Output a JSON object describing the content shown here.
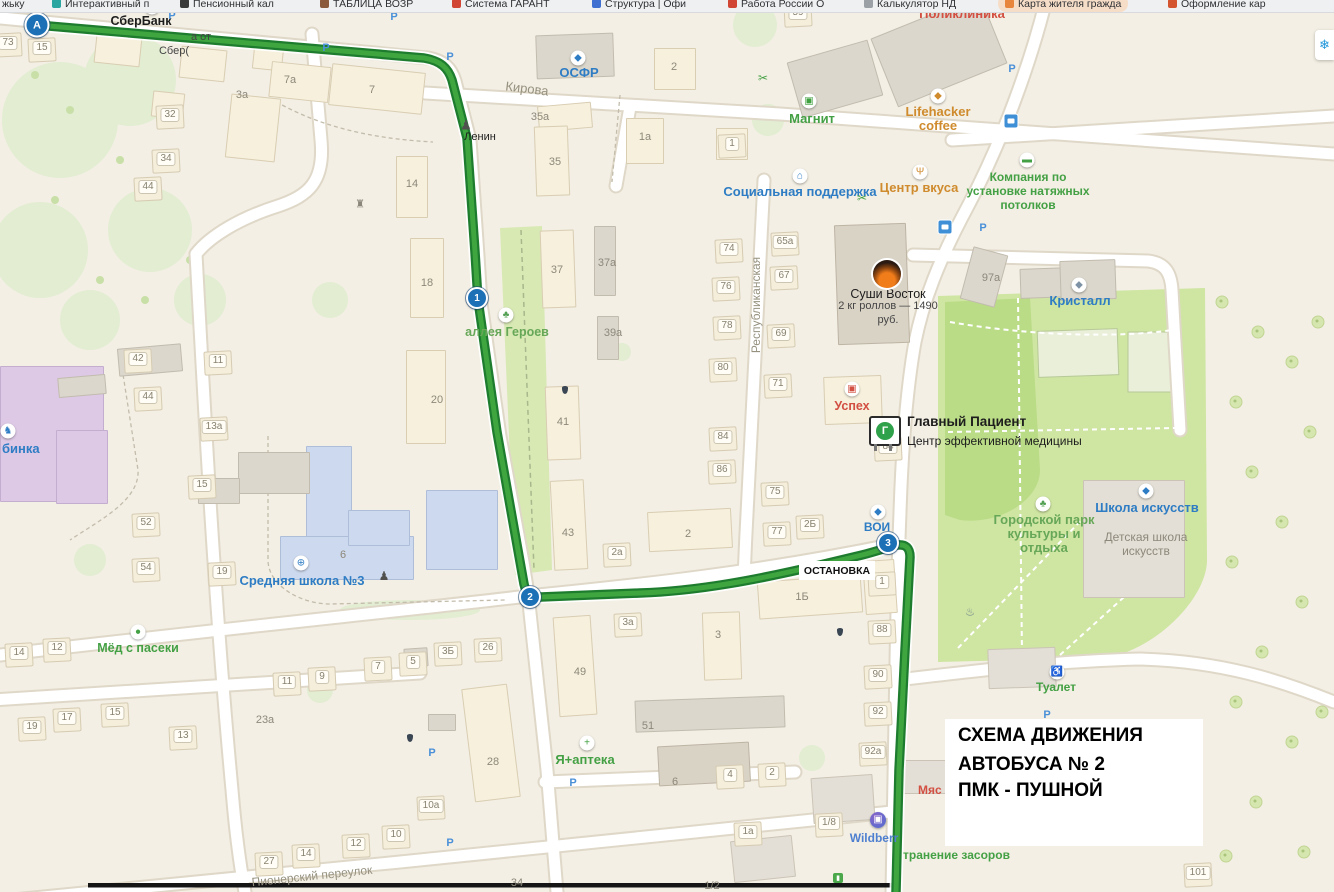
{
  "browser_bar": {
    "bookmarks": [
      {
        "label": "жьку",
        "icon": "",
        "x": 2
      },
      {
        "label": "Интерактивный п",
        "icon": "#2aa5a0",
        "x": 52
      },
      {
        "label": "Пенсионный кал",
        "icon": "#3a3a3a",
        "x": 180
      },
      {
        "label": "ТАБЛИЦА ВОЗР",
        "icon": "#8b5a3c",
        "x": 320
      },
      {
        "label": "Система ГАРАНТ",
        "icon": "#d04534",
        "x": 452
      },
      {
        "label": "Структура | Офи",
        "icon": "#3f6fd0",
        "x": 592
      },
      {
        "label": "Работа России О",
        "icon": "#d04534",
        "x": 728
      },
      {
        "label": "Калькулятор НД",
        "icon": "#9aa0a6",
        "x": 864
      },
      {
        "label": "Карта жителя гражда",
        "icon": "#e8853c",
        "x": 998,
        "highlighted": true
      },
      {
        "label": "Оформление кар",
        "icon": "#d3542e",
        "x": 1168
      }
    ]
  },
  "map": {
    "schema_box": {
      "line1": "СХЕМА ДВИЖЕНИЯ",
      "line2": "АВТОБУСА № 2",
      "line3": "ПМК - ПУШНОЙ"
    },
    "stop_label": "ОСТАНОВКА",
    "billboard_letter": "Г",
    "snowflake": "❄",
    "accent_colors": {
      "route_green": "#3fa53f",
      "marker_blue": "#1c70b6",
      "poi_blue": "#2d7cc4",
      "poi_green": "#44a044",
      "poi_red": "#d24f42",
      "poi_orange": "#cf8b2d"
    },
    "route_markers": [
      {
        "label": "А",
        "x": 37,
        "y": 25,
        "s": 21
      },
      {
        "label": "1",
        "x": 477,
        "y": 298,
        "s": 18
      },
      {
        "label": "2",
        "x": 530,
        "y": 597,
        "s": 18
      },
      {
        "label": "3",
        "x": 888,
        "y": 543,
        "s": 18
      }
    ],
    "labels": [
      {
        "n": "poi-sberbank",
        "t": "СберБанк",
        "x": 141,
        "y": 21,
        "c": "blk",
        "z": 12.5,
        "b": 1
      },
      {
        "n": "poi-sber-ad-line1",
        "t": "а от",
        "x": 201,
        "y": 37,
        "c": "blk2",
        "z": 11
      },
      {
        "n": "poi-sber-ad-line2",
        "t": "Сбер(",
        "x": 174,
        "y": 51,
        "c": "blk2",
        "z": 11
      },
      {
        "n": "poi-osfr",
        "t": "ОСФР",
        "x": 579,
        "y": 73,
        "c": "blue",
        "z": 13
      },
      {
        "n": "street-kirova",
        "t": "Кирова",
        "x": 527,
        "y": 89,
        "c": "street",
        "z": 13,
        "r": 7
      },
      {
        "n": "poi-lenin",
        "t": "Ленин",
        "x": 480,
        "y": 137,
        "c": "blk",
        "z": 11
      },
      {
        "n": "poi-poliklinika",
        "t": "Поликлиника",
        "x": 962,
        "y": 14,
        "c": "red",
        "z": 13
      },
      {
        "n": "poi-magnit",
        "t": "Магнит",
        "x": 812,
        "y": 119,
        "c": "green",
        "z": 13
      },
      {
        "n": "poi-lifehacker",
        "t": "Lifehacker\ncoffee",
        "x": 938,
        "y": 119,
        "c": "orange",
        "z": 13
      },
      {
        "n": "poi-centr-vkusa",
        "t": "Центр вкуса",
        "x": 919,
        "y": 188,
        "c": "orange",
        "z": 13
      },
      {
        "n": "poi-potolki",
        "t": "Компания по\nустановке натяжных\nпотолков",
        "x": 1028,
        "y": 191,
        "c": "green",
        "z": 12
      },
      {
        "n": "poi-soc-podderzhka",
        "t": "Социальная поддержка",
        "x": 800,
        "y": 192,
        "c": "blue",
        "z": 13
      },
      {
        "n": "poi-sushi-title",
        "t": "Суши Восток",
        "x": 888,
        "y": 294,
        "c": "blk",
        "z": 12.5
      },
      {
        "n": "poi-sushi-sub",
        "t": "2 кг роллов — 1490\nруб.",
        "x": 888,
        "y": 313,
        "c": "blk2",
        "z": 11
      },
      {
        "n": "street-respublikanskaya",
        "t": "Республиканская",
        "x": 756,
        "y": 305,
        "c": "street",
        "z": 12,
        "r": -90
      },
      {
        "n": "poi-kristall",
        "t": "Кристалл",
        "x": 1080,
        "y": 301,
        "c": "blue",
        "z": 13
      },
      {
        "n": "poi-uspeh",
        "t": "Успех",
        "x": 852,
        "y": 406,
        "c": "red",
        "z": 12.5
      },
      {
        "n": "poi-glavny-patsient",
        "t": "Главный Пациент",
        "x": 907,
        "y": 422,
        "c": "blk",
        "z": 13.5,
        "b": 1,
        "a": "l"
      },
      {
        "n": "poi-glavny-patsient-sub",
        "t": "Центр эффективной медицины",
        "x": 907,
        "y": 441,
        "c": "blk",
        "z": 12,
        "a": "l"
      },
      {
        "n": "poi-voi",
        "t": "ВОИ",
        "x": 877,
        "y": 527,
        "c": "blue",
        "z": 12
      },
      {
        "n": "poi-gorodskoy-park",
        "t": "Городской парк\nкультуры и\nотдыха",
        "x": 1044,
        "y": 534,
        "c": "parkgreen",
        "z": 13
      },
      {
        "n": "poi-shkola-iskusstv",
        "t": "Школа искусств",
        "x": 1147,
        "y": 508,
        "c": "blue",
        "z": 13
      },
      {
        "n": "poi-detskaya-shkola",
        "t": "Детская школа\nискусств",
        "x": 1146,
        "y": 544,
        "c": "grey",
        "z": 12
      },
      {
        "n": "poi-srednyaya-shkola-3",
        "t": "Средняя школа №3",
        "x": 302,
        "y": 581,
        "c": "blue",
        "z": 13
      },
      {
        "n": "poi-alleya-geroev",
        "t": "аллея Героев",
        "x": 507,
        "y": 332,
        "c": "parkgreen",
        "z": 12.5
      },
      {
        "n": "poi-med-s-paseki",
        "t": "Мёд с пасеки",
        "x": 138,
        "y": 648,
        "c": "green",
        "z": 12.5
      },
      {
        "n": "poi-ya-apteka",
        "t": "Я+аптека",
        "x": 585,
        "y": 760,
        "c": "green",
        "z": 13
      },
      {
        "n": "poi-tualet",
        "t": "Туалет",
        "x": 1056,
        "y": 687,
        "c": "green",
        "z": 12
      },
      {
        "n": "poi-wildberries",
        "t": "Wildberr",
        "x": 874,
        "y": 838,
        "c": "wb",
        "z": 12
      },
      {
        "n": "poi-zasory",
        "t": "транение засоров",
        "x": 903,
        "y": 855,
        "c": "green",
        "z": 12,
        "a": "l"
      },
      {
        "n": "poi-myas",
        "t": "Мяс",
        "x": 918,
        "y": 790,
        "c": "red",
        "z": 12,
        "a": "l"
      },
      {
        "n": "poi-ryabinka",
        "t": "бинка",
        "x": 2,
        "y": 449,
        "c": "blue",
        "z": 13,
        "a": "l"
      },
      {
        "n": "street-pionersky",
        "t": "Пионерский переулок",
        "x": 312,
        "y": 876,
        "c": "street",
        "z": 12,
        "r": -6
      }
    ],
    "building_numbers_chip": [
      [
        "73",
        8,
        43
      ],
      [
        "15",
        42,
        48
      ],
      [
        "32",
        170,
        115
      ],
      [
        "34",
        166,
        159
      ],
      [
        "44",
        148,
        187
      ],
      [
        "42",
        138,
        359
      ],
      [
        "44",
        148,
        397
      ],
      [
        "11",
        218,
        361
      ],
      [
        "13а",
        214,
        427
      ],
      [
        "15",
        202,
        485
      ],
      [
        "52",
        146,
        523
      ],
      [
        "54",
        146,
        568
      ],
      [
        "19",
        222,
        572
      ],
      [
        "14",
        19,
        653
      ],
      [
        "12",
        57,
        648
      ],
      [
        "19",
        32,
        727
      ],
      [
        "17",
        67,
        718
      ],
      [
        "15",
        115,
        713
      ],
      [
        "13",
        183,
        736
      ],
      [
        "11",
        287,
        682
      ],
      [
        "9",
        322,
        677
      ],
      [
        "7",
        378,
        667
      ],
      [
        "5",
        413,
        662
      ],
      [
        "3Б",
        448,
        652
      ],
      [
        "26",
        488,
        648
      ],
      [
        "2а",
        617,
        553
      ],
      [
        "3а",
        628,
        623
      ],
      [
        "59",
        798,
        13
      ],
      [
        "74",
        729,
        249
      ],
      [
        "65а",
        785,
        242
      ],
      [
        "67",
        784,
        276
      ],
      [
        "76",
        726,
        287
      ],
      [
        "78",
        727,
        326
      ],
      [
        "69",
        781,
        334
      ],
      [
        "80",
        723,
        368
      ],
      [
        "71",
        778,
        384
      ],
      [
        "84",
        723,
        437
      ],
      [
        "86",
        722,
        470
      ],
      [
        "75",
        775,
        492
      ],
      [
        "77",
        777,
        532
      ],
      [
        "2Б",
        810,
        525
      ],
      [
        "1",
        882,
        582
      ],
      [
        "88",
        882,
        630
      ],
      [
        "90",
        878,
        675
      ],
      [
        "92",
        878,
        712
      ],
      [
        "92а",
        873,
        752
      ],
      [
        "84",
        888,
        447
      ],
      [
        "1",
        732,
        144
      ],
      [
        "27",
        269,
        862
      ],
      [
        "14",
        306,
        854
      ],
      [
        "12",
        356,
        844
      ],
      [
        "10",
        396,
        835
      ],
      [
        "10а",
        431,
        806
      ],
      [
        "1а",
        748,
        832
      ],
      [
        "1/8",
        829,
        823
      ],
      [
        "101",
        1198,
        873
      ],
      [
        "4",
        730,
        775
      ],
      [
        "2",
        772,
        773
      ]
    ],
    "building_numbers_plain": [
      [
        "3а",
        242,
        95
      ],
      [
        "7а",
        290,
        80
      ],
      [
        "7",
        372,
        90
      ],
      [
        "14",
        412,
        184
      ],
      [
        "18",
        427,
        283
      ],
      [
        "20",
        437,
        400
      ],
      [
        "35а",
        540,
        117
      ],
      [
        "35",
        555,
        162
      ],
      [
        "37",
        557,
        270
      ],
      [
        "37а",
        607,
        263
      ],
      [
        "39а",
        613,
        333
      ],
      [
        "41",
        563,
        422
      ],
      [
        "43",
        568,
        533
      ],
      [
        "2",
        688,
        534
      ],
      [
        "49",
        580,
        672
      ],
      [
        "28",
        493,
        762
      ],
      [
        "51",
        648,
        726
      ],
      [
        "1Б",
        802,
        597
      ],
      [
        "3",
        718,
        635
      ],
      [
        "97а",
        991,
        278
      ],
      [
        "6",
        343,
        555
      ],
      [
        "2",
        674,
        67
      ],
      [
        "1а",
        645,
        137
      ],
      [
        "23а",
        265,
        720
      ],
      [
        "34",
        517,
        883
      ],
      [
        "6",
        675,
        782
      ],
      [
        "1/2",
        712,
        886
      ]
    ],
    "icons": [
      {
        "n": "sber-logo-icon",
        "g": "◆",
        "c": "#57a636",
        "x": 152,
        "y": 7,
        "bg": 1
      },
      {
        "n": "osfr-icon",
        "g": "◆",
        "c": "#2d7cc4",
        "x": 578,
        "y": 58,
        "bg": 1
      },
      {
        "n": "lenin-monument-icon",
        "g": "♟",
        "c": "#50504e",
        "x": 466,
        "y": 125,
        "s": 13
      },
      {
        "n": "monument-icon",
        "g": "♜",
        "c": "#8a867a",
        "x": 360,
        "y": 205,
        "s": 11
      },
      {
        "n": "magnit-cart-icon",
        "g": "▣",
        "c": "#3fa03f",
        "x": 809,
        "y": 101,
        "bg": 1
      },
      {
        "n": "lifehacker-icon",
        "g": "◆",
        "c": "#cf8b2d",
        "x": 938,
        "y": 96,
        "bg": 1
      },
      {
        "n": "restaurant-icon",
        "g": "Ψ",
        "c": "#cf8b2d",
        "x": 920,
        "y": 172,
        "bg": 1
      },
      {
        "n": "paint-roller-icon",
        "g": "▬",
        "c": "#44a044",
        "x": 1027,
        "y": 160,
        "bg": 1
      },
      {
        "n": "social-house-icon",
        "g": "⌂",
        "c": "#2d7cc4",
        "x": 800,
        "y": 176,
        "bg": 1
      },
      {
        "n": "skates-icon",
        "g": "◆",
        "c": "#7d93a5",
        "x": 1079,
        "y": 285,
        "bg": 1
      },
      {
        "n": "shop-icon",
        "g": "▣",
        "c": "#d24f42",
        "x": 852,
        "y": 389,
        "bg": 1
      },
      {
        "n": "voi-icon",
        "g": "◆",
        "c": "#2d7cc4",
        "x": 878,
        "y": 512,
        "bg": 1
      },
      {
        "n": "park-tree-icon",
        "g": "♣",
        "c": "#55a155",
        "x": 1043,
        "y": 504,
        "bg": 1
      },
      {
        "n": "art-school-icon",
        "g": "◆",
        "c": "#2d7cc4",
        "x": 1146,
        "y": 491,
        "bg": 1
      },
      {
        "n": "school-globe-icon",
        "g": "⊕",
        "c": "#2d7cc4",
        "x": 301,
        "y": 563,
        "bg": 1
      },
      {
        "n": "school-statue-icon",
        "g": "♟",
        "c": "#50504e",
        "x": 384,
        "y": 576,
        "s": 12
      },
      {
        "n": "alley-tree-icon",
        "g": "♣",
        "c": "#55a155",
        "x": 506,
        "y": 315,
        "bg": 1
      },
      {
        "n": "honey-icon",
        "g": "●",
        "c": "#44a044",
        "x": 138,
        "y": 632,
        "bg": 1
      },
      {
        "n": "pharmacy-cross-icon",
        "g": "+",
        "c": "#3fa03f",
        "x": 587,
        "y": 743,
        "bg": 1
      },
      {
        "n": "wc-icon",
        "g": "♿",
        "c": "#44a044",
        "x": 1057,
        "y": 672,
        "bg": 1
      },
      {
        "n": "wildberries-icon",
        "g": "▣",
        "c": "#ffffff",
        "x": 878,
        "y": 820,
        "bg": 2
      },
      {
        "n": "scissors-icon",
        "g": "✂",
        "c": "#44a044",
        "x": 763,
        "y": 78,
        "s": 12
      },
      {
        "n": "scissors-icon",
        "g": "✂",
        "c": "#44a044",
        "x": 862,
        "y": 198,
        "s": 12
      },
      {
        "n": "fountain-icon",
        "g": "♨",
        "c": "#6a7f8a",
        "x": 970,
        "y": 613,
        "s": 11
      },
      {
        "n": "rocking-horse-icon",
        "g": "♞",
        "c": "#2d7cc4",
        "x": 8,
        "y": 431,
        "bg": 1
      },
      {
        "n": "bag-icon",
        "g": "▮",
        "c": "#ffffff",
        "x": 838,
        "y": 878,
        "bg": 3
      }
    ],
    "parking": [
      [
        172,
        16
      ],
      [
        394,
        17
      ],
      [
        326,
        48
      ],
      [
        450,
        57
      ],
      [
        1012,
        69
      ],
      [
        983,
        228
      ],
      [
        1047,
        715
      ],
      [
        432,
        753
      ],
      [
        573,
        783
      ],
      [
        450,
        843
      ]
    ],
    "parking_glyph": "P",
    "bus_stops": [
      [
        1011,
        121
      ],
      [
        945,
        227
      ]
    ],
    "drops": [
      [
        565,
        390
      ],
      [
        840,
        632
      ],
      [
        410,
        738
      ]
    ]
  }
}
